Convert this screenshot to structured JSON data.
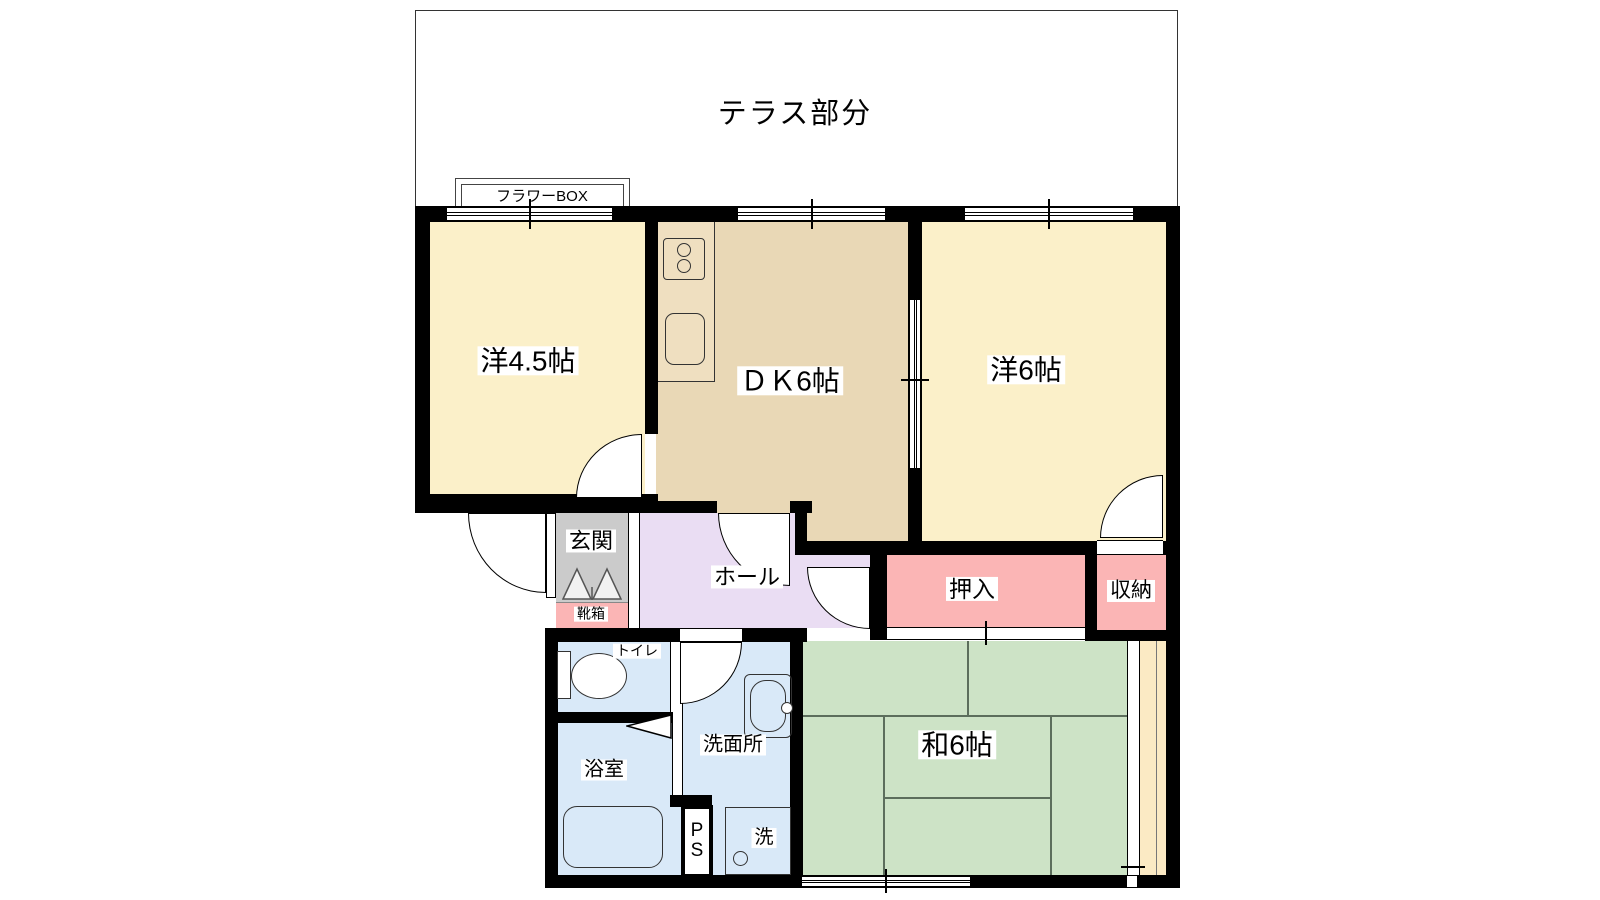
{
  "plan": {
    "terrace_label": "テラス部分",
    "flower_box_label": "フラワーBOX",
    "rooms": {
      "western_4_5": "洋4.5帖",
      "dk": "ＤＫ6帖",
      "western_6": "洋6帖",
      "japanese_6": "和6帖",
      "genkan": "玄関",
      "shoe_box": "靴箱",
      "hall": "ホール",
      "oshiire": "押入",
      "storage": "収納",
      "toilet": "トイレ",
      "bathroom": "浴室",
      "washroom": "洗面所",
      "pipe_space": "P\nS",
      "washer": "洗"
    },
    "colors": {
      "wall": "#000000",
      "western_room": "#FBF0C9",
      "dk": "#E9D8B6",
      "counter": "#EFDFC0",
      "hall": "#EADDF3",
      "genkan": "#CBCBCB",
      "closet_pink": "#FBB5B5",
      "bath_blue": "#D9E9F8",
      "tatami_green": "#CDE3C6",
      "engawa": "#FBEAC4"
    }
  }
}
